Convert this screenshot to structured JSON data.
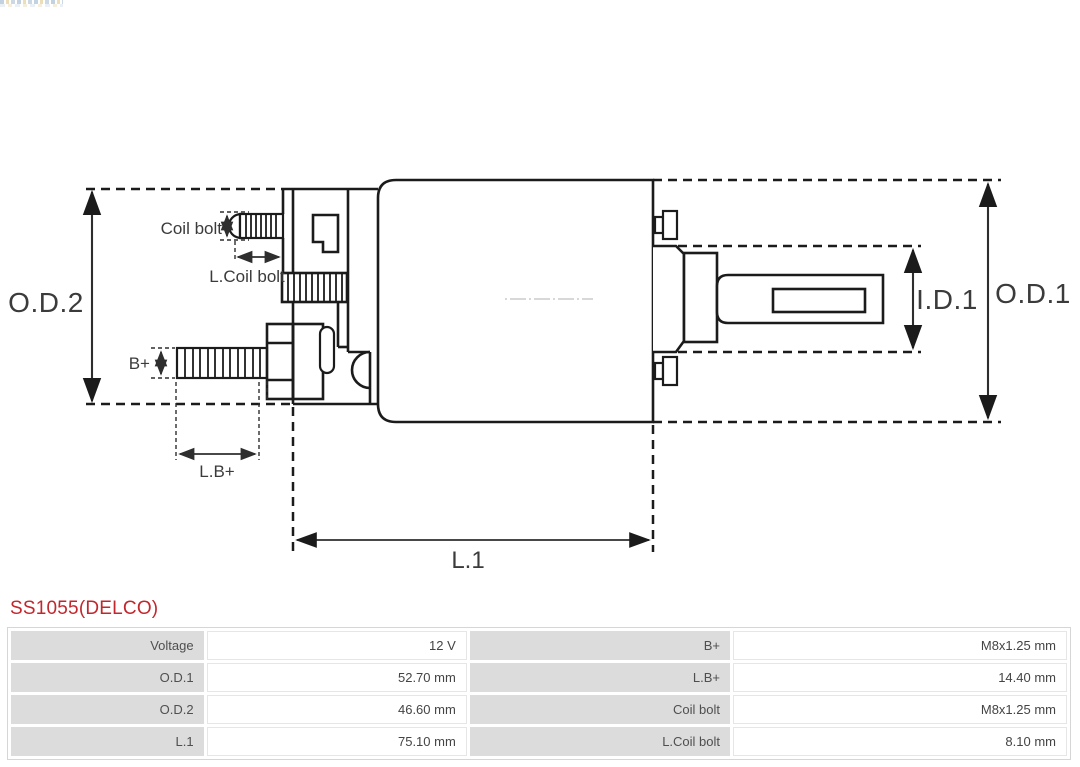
{
  "colors": {
    "title_red": "#c1272d",
    "cell_gray": "#dcdcdc",
    "line_dark": "#1b1b1b",
    "dim_line": "#2e2e2e",
    "dim_text": "#3b3b3b",
    "table_text": "#4a4a4a",
    "centerline_gray": "#cccccc"
  },
  "title": "SS1055(DELCO)",
  "diagram": {
    "labels": {
      "od2": "O.D.2",
      "od1": "O.D.1",
      "id1": "I.D.1",
      "l1": "L.1",
      "lb_plus": "L.B+",
      "b_plus": "B+",
      "coil_bolt": "Coil bolt",
      "l_coil_bolt": "L.Coil bolt"
    }
  },
  "table": {
    "rows": [
      {
        "c": [
          "Voltage",
          "12 V",
          "B+",
          "M8x1.25 mm"
        ]
      },
      {
        "c": [
          "O.D.1",
          "52.70 mm",
          "L.B+",
          "14.40 mm"
        ]
      },
      {
        "c": [
          "O.D.2",
          "46.60 mm",
          "Coil bolt",
          "M8x1.25 mm"
        ]
      },
      {
        "c": [
          "L.1",
          "75.10 mm",
          "L.Coil bolt",
          "8.10 mm"
        ]
      }
    ]
  }
}
